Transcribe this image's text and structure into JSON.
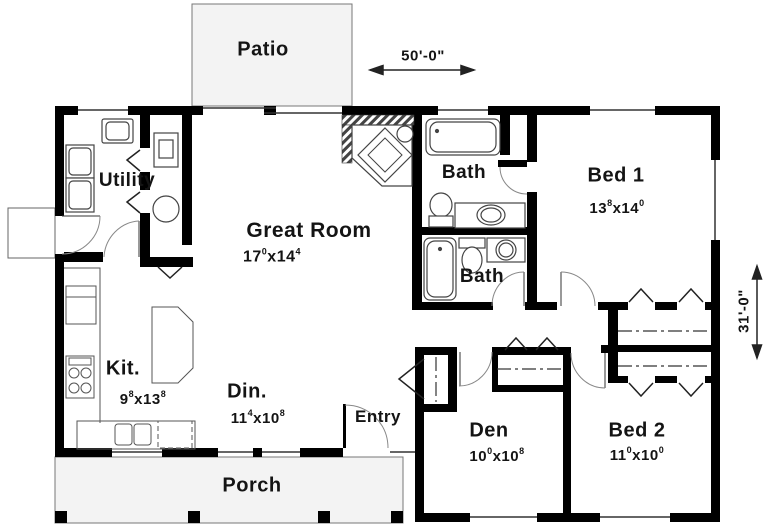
{
  "plan": {
    "dim_sep": "x",
    "overall_width": "50'-0\"",
    "overall_depth": "31'-0\"",
    "patio": {
      "label": "Patio"
    },
    "porch": {
      "label": "Porch"
    },
    "entry": {
      "label": "Entry"
    },
    "utility": {
      "label": "Utility"
    },
    "great_room": {
      "label": "Great Room",
      "dim": {
        "a": "17",
        "as": "0",
        "b": "14",
        "bs": "4"
      }
    },
    "kitchen": {
      "label": "Kit.",
      "dim": {
        "a": "9",
        "as": "8",
        "b": "13",
        "bs": "8"
      }
    },
    "dining": {
      "label": "Din.",
      "dim": {
        "a": "11",
        "as": "4",
        "b": "10",
        "bs": "8"
      }
    },
    "bath_upper": {
      "label": "Bath"
    },
    "bath_lower": {
      "label": "Bath"
    },
    "bed1": {
      "label": "Bed 1",
      "dim": {
        "a": "13",
        "as": "8",
        "b": "14",
        "bs": "0"
      }
    },
    "bed2": {
      "label": "Bed 2",
      "dim": {
        "a": "11",
        "as": "0",
        "b": "10",
        "bs": "0"
      }
    },
    "den": {
      "label": "Den",
      "dim": {
        "a": "10",
        "as": "0",
        "b": "10",
        "bs": "8"
      }
    }
  },
  "colors": {
    "wall": "#000000",
    "outdoor_fill": "#f3f3f3",
    "line": "#333333",
    "arc": "#888888"
  }
}
